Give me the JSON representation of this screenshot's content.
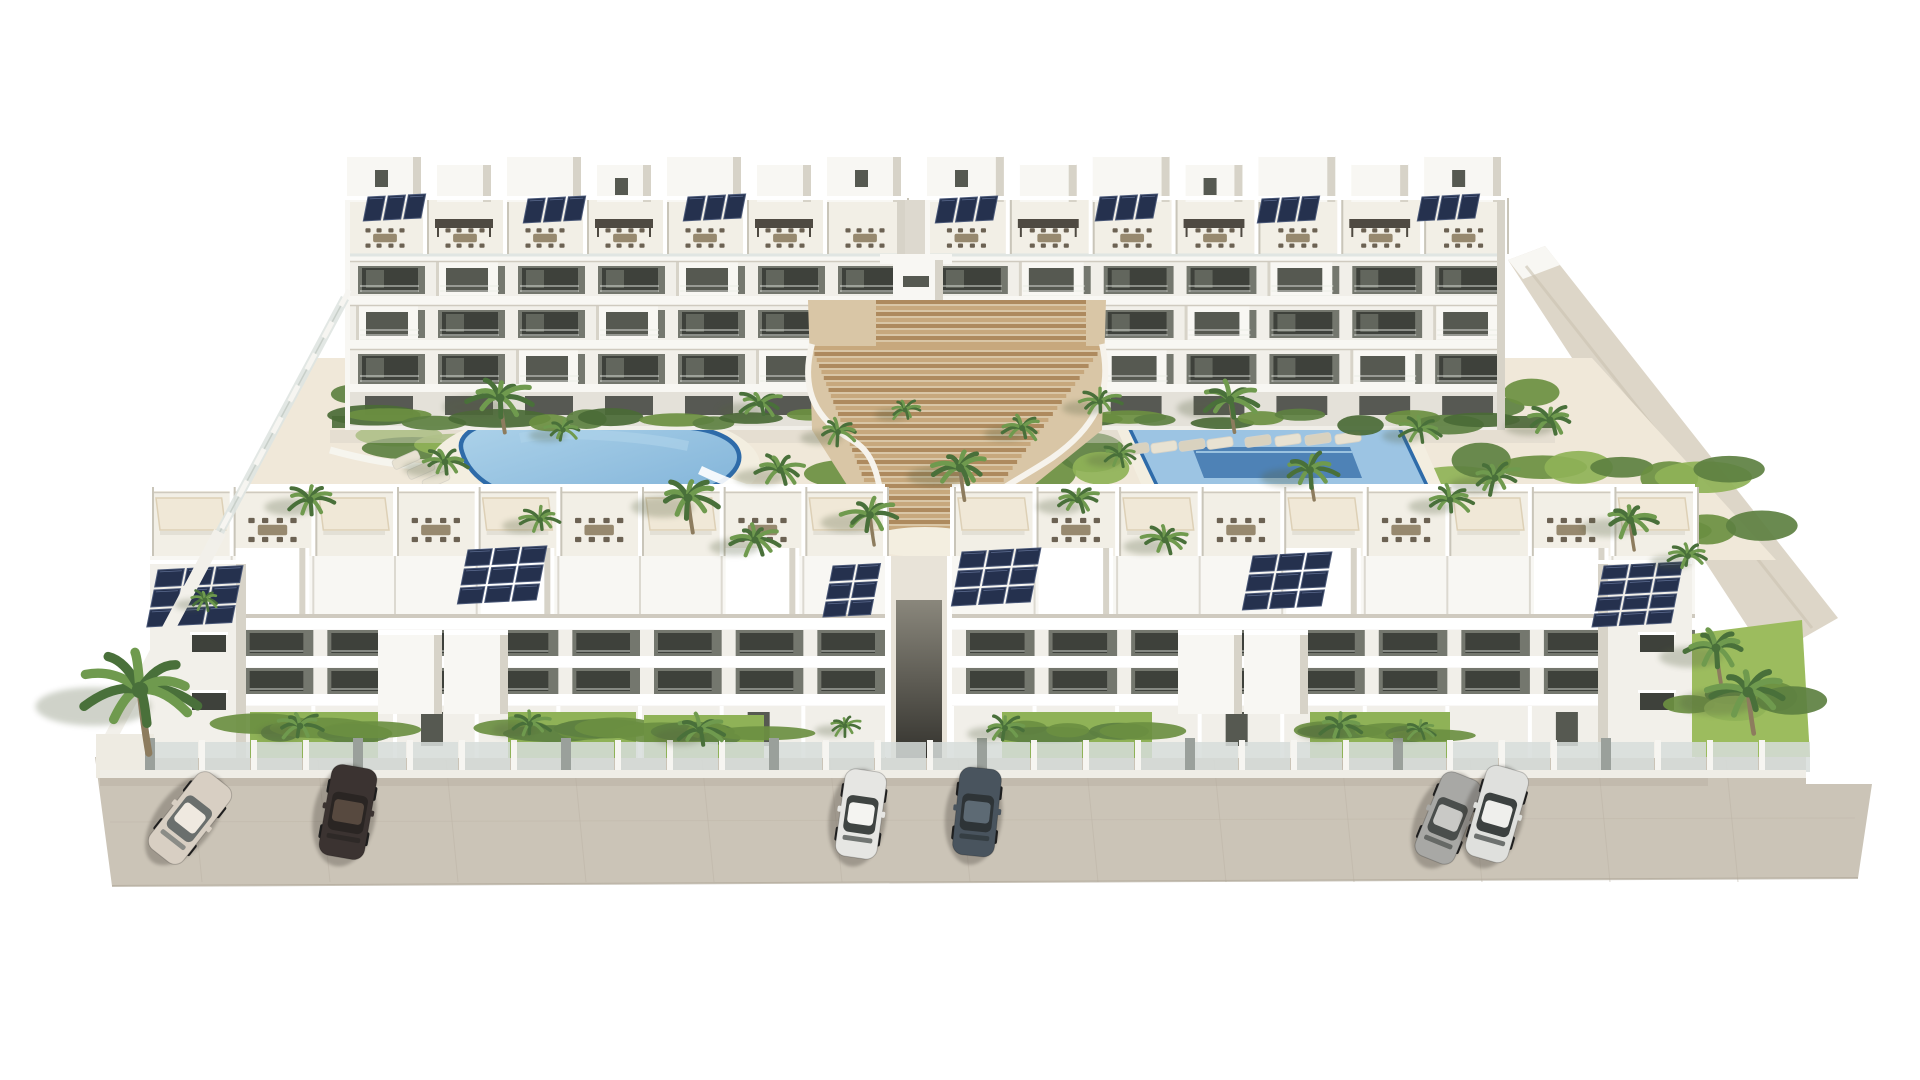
{
  "scene": {
    "description": "Aerial 3D architectural rendering of a white residential apartment complex with two swimming pools, central wooden staircase, palm trees, rooftop solar panels and street parking",
    "canvas": {
      "width": 1920,
      "height": 1080
    }
  },
  "palette": {
    "bg": "#ffffff",
    "white": "#ffffff",
    "street": "#cbc4b7",
    "streetSeam": "#bdb5a7",
    "streetEdge": "#b2aa9b",
    "bldg": "#f1efe9",
    "bldgHi": "#f8f7f3",
    "bldgShade": "#e4e1d9",
    "shade": "#d7d3c8",
    "shade2": "#c9c5b9",
    "recess": "#74776e",
    "win": "#3e413b",
    "win2": "#565951",
    "rail": "#e9ebe5",
    "slabShadow": "#cfcabf",
    "roofDeck": "#f2efe6",
    "awning": "#4f4a42",
    "pergola": "#f0e8d7",
    "pergolaEdge": "#ddd0b6",
    "glassRail": "#dfe5e2",
    "fenceGlass": "#d7ddda",
    "fencePost": "#f6f5f1",
    "fencePillar": "#9aa09b",
    "wallBeige": "#ddd6c8",
    "wallBeigeDark": "#cbc3b2",
    "wood": "#c7a87d",
    "wood2": "#ae8a5e",
    "stairEdge": "#f6f3ec",
    "courtyard": "#f0e8d9",
    "deck": "#f3eee0",
    "grass": "#8fb257",
    "grassDark": "#6b8f41",
    "hedge": "#4a6a36",
    "shrub": "#5d8041",
    "palm1": "#6f9a4e",
    "palm2": "#49703a",
    "trunk": "#8d7c5e",
    "poolRim": "#2e6ba9",
    "poolWater": "#7fb2d8",
    "poolLight": "#aed3ea",
    "poolDeep": "#4e82b6",
    "poolWater2": "#9cc4e3",
    "solar": "#25314e",
    "solarEdge": "#4a5878",
    "furn": "#97896f",
    "furnDark": "#6c6253",
    "vegShadow": "#55603f",
    "carShadow": "#3a362f"
  },
  "objects": {
    "street": {
      "top": 757,
      "bottom": 886,
      "left": 95,
      "right": 1872,
      "notch_x": 1806
    },
    "top_blocks": [
      {
        "x0": 345,
        "w": 560,
        "units": 7
      },
      {
        "x0": 925,
        "w": 580,
        "units": 7
      }
    ],
    "bottom_blocks": [
      {
        "x0": 150,
        "w": 735,
        "units": 9
      },
      {
        "x0": 952,
        "w": 743,
        "units": 9
      }
    ],
    "towers": [
      {
        "x": 150,
        "w": 96,
        "y": 560,
        "h": 198,
        "shade": "right"
      },
      {
        "x": 1598,
        "w": 94,
        "y": 560,
        "h": 198,
        "shade": "left"
      }
    ],
    "porches": [
      [
        378,
        630
      ],
      [
        444,
        630
      ],
      [
        1178,
        630
      ],
      [
        1244,
        630
      ]
    ],
    "gardens": [
      [
        250,
        712,
        128
      ],
      [
        508,
        712,
        128
      ],
      [
        644,
        715,
        120
      ],
      [
        1002,
        712,
        150
      ],
      [
        1310,
        712,
        140
      ]
    ],
    "right_garden": {
      "poly": "1692,634 1802,620 1810,757 1692,757"
    },
    "pools": {
      "left": {
        "type": "kidney",
        "cx": 595,
        "cy": 463,
        "x": 455,
        "y": 418,
        "w": 290,
        "h": 92
      },
      "right": {
        "type": "rect",
        "outer": "1128,425 1398,425 1430,492 1160,492",
        "inner": "1192,447 1350,447 1362,478 1204,478"
      }
    },
    "loungers_left": [
      [
        406,
        460
      ],
      [
        421,
        470
      ],
      [
        436,
        480
      ]
    ],
    "loungers_right": [
      [
        1136,
        449
      ],
      [
        1164,
        447
      ],
      [
        1192,
        445
      ],
      [
        1220,
        443
      ],
      [
        1258,
        441
      ],
      [
        1288,
        440
      ],
      [
        1318,
        439
      ],
      [
        1348,
        438
      ]
    ],
    "pool_pergolas": [
      [
        593,
        388,
        48,
        24
      ],
      [
        1176,
        386,
        62,
        17
      ],
      [
        1262,
        386,
        62,
        17
      ]
    ],
    "stairs": {
      "topY": 300,
      "fanTopY": 346,
      "bottomY": 534,
      "topL": 876,
      "topR": 1086,
      "fanL": 812,
      "fanR": 1102,
      "botL": 886,
      "botR": 962
    },
    "passage": {
      "x": 886,
      "y": 556,
      "w": 66,
      "h": 202
    },
    "solar_arrays_top": [
      [
        368,
        197
      ],
      [
        528,
        199
      ],
      [
        688,
        197
      ],
      [
        940,
        199
      ],
      [
        1100,
        197
      ],
      [
        1262,
        199
      ],
      [
        1422,
        197
      ]
    ],
    "solar_arrays_bottom": [
      {
        "x": 158,
        "y": 570,
        "c": 3,
        "r": 3,
        "pw": 26,
        "ph": 17
      },
      {
        "x": 468,
        "y": 550,
        "c": 3,
        "r": 3,
        "pw": 24,
        "ph": 16
      },
      {
        "x": 833,
        "y": 566,
        "c": 2,
        "r": 3,
        "pw": 22,
        "ph": 15
      },
      {
        "x": 962,
        "y": 552,
        "c": 3,
        "r": 3,
        "pw": 24,
        "ph": 16
      },
      {
        "x": 1253,
        "y": 556,
        "c": 3,
        "r": 3,
        "pw": 24,
        "ph": 16
      },
      {
        "x": 1604,
        "y": 566,
        "c": 3,
        "r": 4,
        "pw": 24,
        "ph": 13
      }
    ],
    "palms_courtyard": [
      [
        500,
        398,
        30
      ],
      [
        760,
        404,
        22
      ],
      [
        905,
        410,
        16
      ],
      [
        1100,
        402,
        20
      ],
      [
        1230,
        400,
        28
      ],
      [
        1550,
        420,
        24
      ],
      [
        445,
        462,
        22
      ],
      [
        563,
        430,
        18
      ],
      [
        688,
        498,
        30
      ],
      [
        780,
        470,
        24
      ],
      [
        838,
        432,
        20
      ],
      [
        870,
        515,
        26
      ],
      [
        960,
        468,
        28
      ],
      [
        1022,
        428,
        20
      ],
      [
        1078,
        500,
        22
      ],
      [
        1120,
        455,
        18
      ],
      [
        1310,
        470,
        26
      ],
      [
        1420,
        430,
        20
      ],
      [
        1495,
        478,
        24
      ],
      [
        1630,
        520,
        26
      ],
      [
        1688,
        556,
        20
      ],
      [
        540,
        520,
        20
      ],
      [
        755,
        540,
        24
      ],
      [
        1165,
        540,
        22
      ],
      [
        1450,
        500,
        22
      ],
      [
        310,
        500,
        24
      ]
    ],
    "palms_garden": [
      [
        300,
        726,
        22
      ],
      [
        530,
        724,
        20
      ],
      [
        700,
        730,
        24
      ],
      [
        845,
        726,
        16
      ],
      [
        1005,
        728,
        20
      ],
      [
        1340,
        726,
        22
      ],
      [
        1420,
        730,
        16
      ],
      [
        1716,
        648,
        30
      ],
      [
        1748,
        692,
        36
      ],
      [
        140,
        690,
        55
      ],
      [
        205,
        600,
        16
      ]
    ],
    "cars": [
      {
        "name": "cream-sedan",
        "x": 190,
        "y": 818,
        "rot": 38,
        "L": 96,
        "W": 42,
        "body": "#d8cfc3",
        "roof": "#efe9e0",
        "glass": "#6a6f6d"
      },
      {
        "name": "dark-brown-sedan",
        "x": 348,
        "y": 812,
        "rot": 10,
        "L": 92,
        "W": 46,
        "body": "#3b3331",
        "roof": "#57493f",
        "glass": "#2a2523"
      },
      {
        "name": "white-sedan",
        "x": 861,
        "y": 814,
        "rot": 8,
        "L": 88,
        "W": 42,
        "body": "#e6e6e3",
        "roof": "#f4f4f1",
        "glass": "#3f4442"
      },
      {
        "name": "blue-gray-sedan",
        "x": 977,
        "y": 812,
        "rot": 6,
        "L": 88,
        "W": 42,
        "body": "#49545e",
        "roof": "#5d6a74",
        "glass": "#2e3437"
      },
      {
        "name": "gray-sedan",
        "x": 1448,
        "y": 818,
        "rot": 22,
        "L": 90,
        "W": 42,
        "body": "#a8a8a5",
        "roof": "#c9c9c6",
        "glass": "#4a4e4c"
      },
      {
        "name": "white-coupe",
        "x": 1497,
        "y": 814,
        "rot": 16,
        "L": 94,
        "W": 44,
        "body": "#dfe0dd",
        "roof": "#efefec",
        "glass": "#3c4140"
      }
    ]
  }
}
